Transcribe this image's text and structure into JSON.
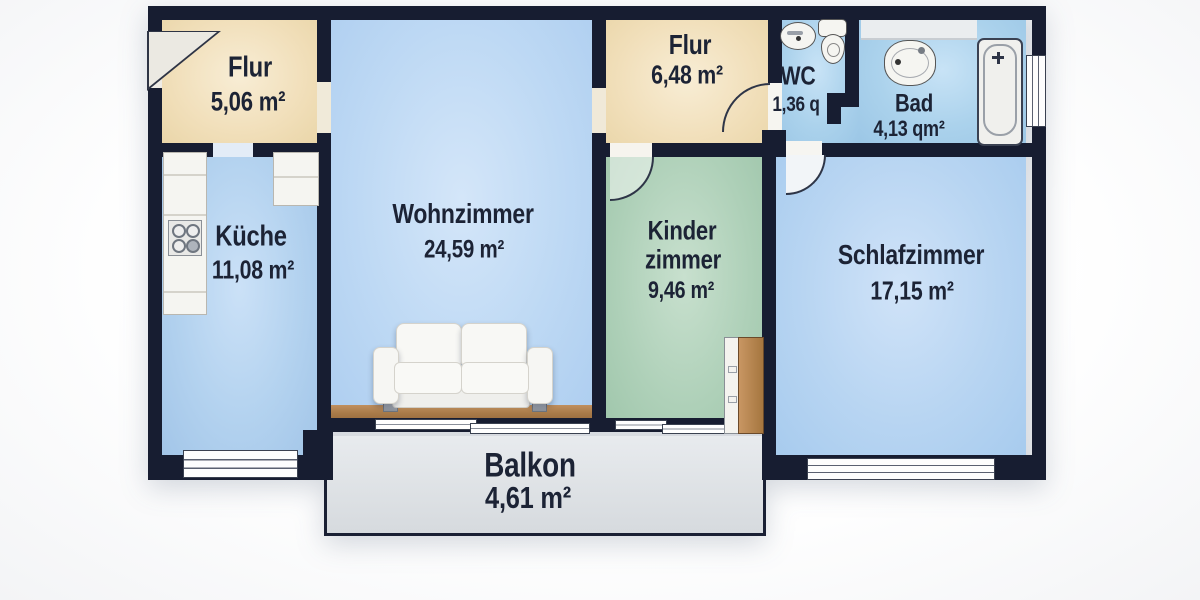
{
  "meta": {
    "type": "apartment-floor-plan",
    "language": "de"
  },
  "rooms": {
    "flur_entry": {
      "name": "Flur",
      "area": "5,06 m²"
    },
    "kueche": {
      "name": "Küche",
      "area": "11,08 m²"
    },
    "wohnzimmer": {
      "name": "Wohnzimmer",
      "area": "24,59 m²"
    },
    "flur_center": {
      "name": "Flur",
      "area": "6,48 m²"
    },
    "wc": {
      "name": "WC",
      "area": "1,36 q"
    },
    "bad": {
      "name": "Bad",
      "area": "4,13 qm²"
    },
    "kinderzimmer": {
      "name_line1": "Kinder",
      "name_line2": "zimmer",
      "area": "9,46 m²"
    },
    "schlafzimmer": {
      "name": "Schlafzimmer",
      "area": "17,15 m²"
    },
    "balkon": {
      "name": "Balkon",
      "area": "4,61 m²"
    }
  },
  "palette": {
    "wall": "#171d31",
    "hallway_floor": "#f1dfba",
    "kitchen_floor": "#b3d2ef",
    "living_floor": "#bed9f4",
    "bath_floor": "#abd2ec",
    "child_floor": "#aed0b8",
    "bedroom_floor": "#b8d5f2",
    "balcony_floor": "#dbdfe3",
    "wood": "#aa7c4a",
    "fixture": "#f5f5f1",
    "label_text": "#1c2335"
  }
}
